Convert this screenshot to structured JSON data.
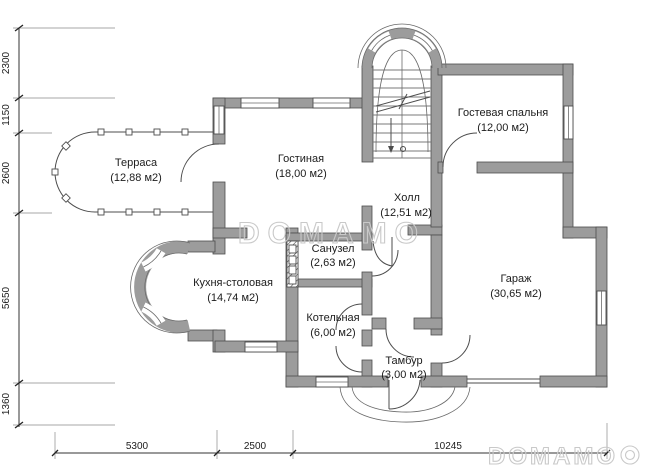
{
  "rooms": {
    "terrace": {
      "name": "Терраса",
      "area": "(12,88 м2)"
    },
    "living_room": {
      "name": "Гостиная",
      "area": "(18,00 м2)"
    },
    "guest_bedroom": {
      "name": "Гостевая спальня",
      "area": "(12,00 м2)"
    },
    "hall": {
      "name": "Холл",
      "area": "(12,51 м2)"
    },
    "bathroom": {
      "name": "Санузел",
      "area": "(2,63 м2)"
    },
    "kitchen_dining": {
      "name": "Кухня-столовая",
      "area": "(14,74 м2)"
    },
    "garage": {
      "name": "Гараж",
      "area": "(30,65 м2)"
    },
    "boiler_room": {
      "name": "Котельная",
      "area": "(6,00 м2)"
    },
    "vestibule": {
      "name": "Тамбур",
      "area": "(3,00 м2)"
    }
  },
  "dimensions": {
    "left": [
      "2300",
      "1150",
      "2600",
      "5650",
      "1360"
    ],
    "bottom": [
      "5300",
      "2500",
      "10245"
    ]
  },
  "watermark": {
    "center": "DOMAMO",
    "corner": "DOMAMO"
  },
  "colors": {
    "wall": "#9c9c9c",
    "line": "#4d4d4d",
    "watermark": "#c9c9c9",
    "background": "#ffffff"
  }
}
